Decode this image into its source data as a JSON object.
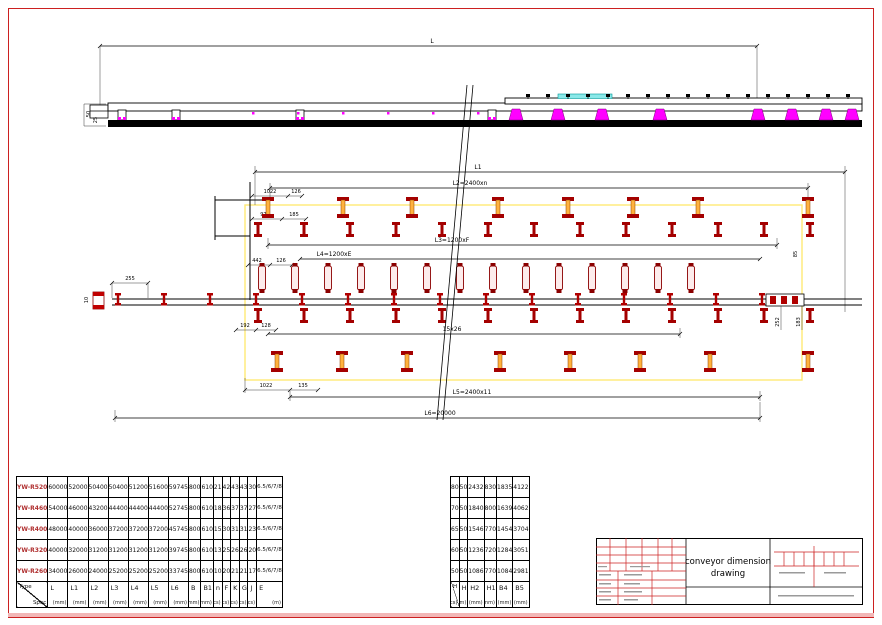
{
  "sheet": {
    "border_color": "#cc2020",
    "accent_color": "#f2b7b7"
  },
  "drawing": {
    "colors": {
      "support_red": "#a40000",
      "core_orange": "#ffb23e",
      "highlight_yellow": "#ffe766",
      "magenta": "#ff00ff",
      "cyan": "#8ae8e8",
      "green": "#00a000"
    },
    "dims": {
      "L": "L",
      "L1": "L1",
      "L2": "L2=2400xn",
      "L3": "L3=1200xF",
      "L4": "L4=1200xE",
      "L5mid": "15x26",
      "L5": "L5=2400x11",
      "L6": "L6=20000",
      "top1022": "1022",
      "top126": "126",
      "d973": "973",
      "d185": "185",
      "d442": "442",
      "mid126": "126",
      "d255": "255",
      "d192": "192",
      "d128": "128",
      "bot1022": "1022",
      "d135": "135",
      "v10": "10",
      "v50": "50",
      "v25": "25",
      "v85": "85",
      "v252": "252",
      "v183": "183"
    }
  },
  "spec_table": {
    "corner": {
      "top": "Type",
      "bottom": "Spec"
    },
    "columns": [
      {
        "label": "L",
        "unit": "(mm)"
      },
      {
        "label": "L1",
        "unit": "(mm)"
      },
      {
        "label": "L2",
        "unit": "(mm)"
      },
      {
        "label": "L3",
        "unit": "(mm)"
      },
      {
        "label": "L4",
        "unit": "(mm)"
      },
      {
        "label": "L5",
        "unit": "(mm)"
      },
      {
        "label": "L6",
        "unit": "(mm)"
      },
      {
        "label": "B",
        "unit": "(mm)"
      },
      {
        "label": "B1",
        "unit": "(mm)"
      },
      {
        "label": "n",
        "unit": "(pcs)"
      },
      {
        "label": "F",
        "unit": "(pcs)"
      },
      {
        "label": "K",
        "unit": "(pcs)"
      },
      {
        "label": "G",
        "unit": "(pcs)"
      },
      {
        "label": "J",
        "unit": "(pcs)"
      },
      {
        "label": "E",
        "unit": "(m)"
      }
    ],
    "rows": [
      {
        "model": "YW-R520",
        "values": [
          "60000",
          "52000",
          "50400",
          "50400",
          "51200",
          "51600",
          "59745",
          "800",
          "610",
          "21",
          "42",
          "43",
          "43",
          "30",
          "6.5/6/7/8"
        ]
      },
      {
        "model": "YW-R460",
        "values": [
          "54000",
          "46000",
          "43200",
          "44400",
          "44400",
          "44400",
          "52745",
          "800",
          "610",
          "18",
          "36",
          "37",
          "37",
          "27",
          "6.5/6/7/8"
        ]
      },
      {
        "model": "YW-R400",
        "values": [
          "48000",
          "40000",
          "36000",
          "37200",
          "37200",
          "37200",
          "45745",
          "800",
          "610",
          "15",
          "30",
          "31",
          "31",
          "23",
          "6.5/6/7/8"
        ]
      },
      {
        "model": "YW-R320",
        "values": [
          "40000",
          "32000",
          "31200",
          "31200",
          "31200",
          "31200",
          "39745",
          "800",
          "610",
          "13",
          "25",
          "26",
          "26",
          "20",
          "6.5/6/7/8"
        ]
      },
      {
        "model": "YW-R260",
        "values": [
          "34000",
          "26000",
          "24000",
          "25200",
          "25200",
          "25200",
          "33745",
          "800",
          "610",
          "10",
          "20",
          "21",
          "21",
          "17",
          "6.5/6/7/8"
        ]
      }
    ]
  },
  "aux_table": {
    "corner": {
      "top": "H",
      "bottom": "(pcs)"
    },
    "columns": [
      {
        "label": "H3",
        "unit": "(mm)"
      },
      {
        "label": "H2",
        "unit": "(mm)"
      },
      {
        "label": "H1",
        "unit": "(mm)"
      },
      {
        "label": "B4",
        "unit": "(mm)"
      },
      {
        "label": "B5",
        "unit": "(mm)"
      }
    ],
    "rows": [
      {
        "values": [
          "80",
          "50",
          "2432",
          "830",
          "1835",
          "4122"
        ]
      },
      {
        "values": [
          "70",
          "50",
          "1840",
          "800",
          "1639",
          "4062"
        ]
      },
      {
        "values": [
          "65",
          "50",
          "1546",
          "770",
          "1454",
          "3704"
        ]
      },
      {
        "values": [
          "60",
          "50",
          "1236",
          "720",
          "1284",
          "3051"
        ]
      },
      {
        "values": [
          "50",
          "50",
          "1086",
          "770",
          "1084",
          "2981"
        ]
      }
    ]
  },
  "title_block": {
    "line1": "conveyor dimension",
    "line2": "drawing"
  }
}
